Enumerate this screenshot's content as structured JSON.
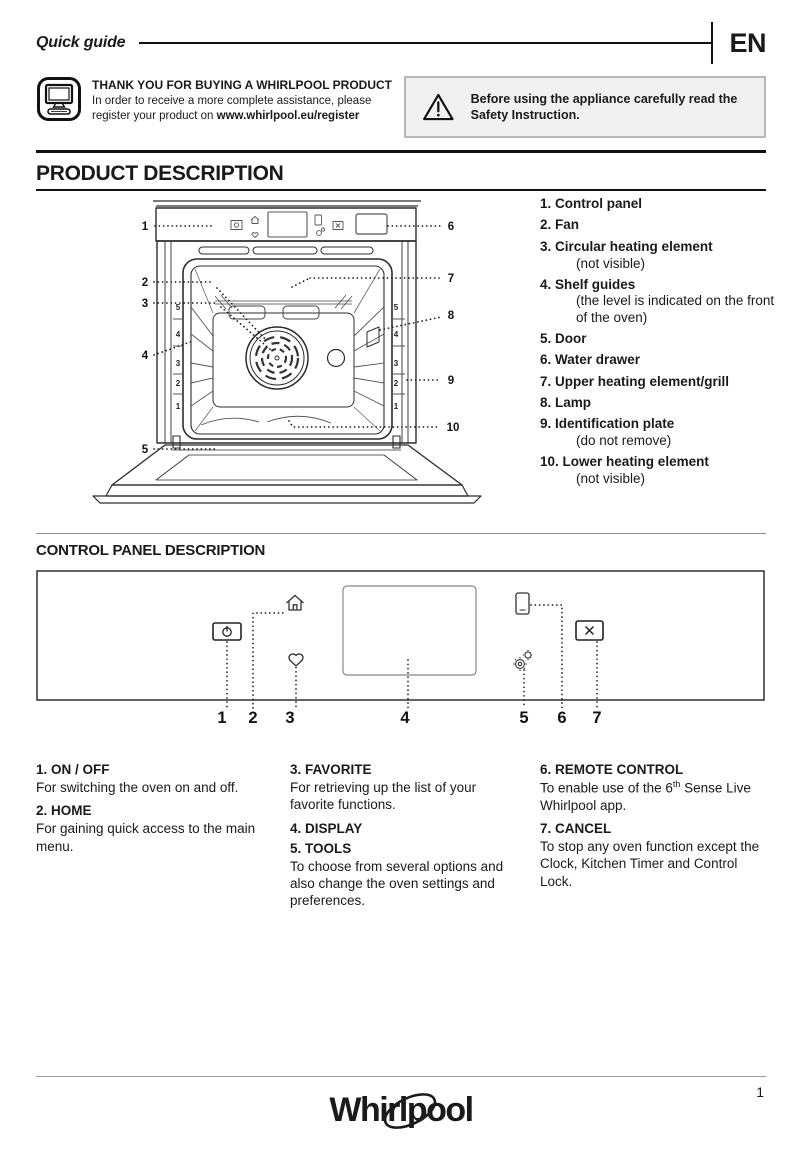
{
  "header": {
    "title": "Quick guide",
    "lang": "EN"
  },
  "register": {
    "title": "THANK YOU FOR BUYING A WHIRLPOOL PRODUCT",
    "line1": "In order to receive a more complete assistance, please",
    "line2": "register your product on ",
    "url": "www.whirlpool.eu/register"
  },
  "warning": {
    "text": "Before using the appliance carefully read the Safety Instruction."
  },
  "product": {
    "heading": "PRODUCT DESCRIPTION",
    "parts": [
      {
        "num": "1.",
        "name": "Control panel"
      },
      {
        "num": "2.",
        "name": "Fan"
      },
      {
        "num": "3.",
        "name": "Circular heating element",
        "note": "(not visible)"
      },
      {
        "num": "4.",
        "name": "Shelf guides",
        "note": "(the level is indicated on the front of the oven)"
      },
      {
        "num": "5.",
        "name": "Door"
      },
      {
        "num": "6.",
        "name": "Water drawer"
      },
      {
        "num": "7.",
        "name": "Upper heating element/grill"
      },
      {
        "num": "8.",
        "name": "Lamp"
      },
      {
        "num": "9.",
        "name": "Identification plate",
        "note": "(do not remove)"
      },
      {
        "num": "10.",
        "name": "Lower heating element",
        "note": "(not visible)"
      }
    ],
    "callouts": [
      "1",
      "2",
      "3",
      "4",
      "5",
      "6",
      "7",
      "8",
      "9",
      "10"
    ],
    "shelf_levels": [
      "5",
      "4",
      "3",
      "2",
      "1"
    ]
  },
  "control_panel": {
    "heading": "CONTROL PANEL DESCRIPTION",
    "callouts": [
      "1",
      "2",
      "3",
      "4",
      "5",
      "6",
      "7"
    ],
    "icons": [
      "power-icon",
      "home-icon",
      "favorite-heart-icon",
      "display-screen",
      "tools-gear-icon",
      "remote-phone-icon",
      "cancel-x-icon"
    ]
  },
  "descriptions": {
    "col1": [
      {
        "title": "1. ON / OFF",
        "text": "For switching the oven on and off."
      },
      {
        "title": "2. HOME",
        "text": "For gaining quick access to the main menu."
      }
    ],
    "col2": [
      {
        "title": "3. FAVORITE",
        "text": "For retrieving up the list of your favorite functions."
      },
      {
        "title": "4. DISPLAY",
        "text": ""
      },
      {
        "title": "5. TOOLS",
        "text": "To choose from several options and also change the oven settings and preferences."
      }
    ],
    "col3": [
      {
        "title": "6. REMOTE CONTROL",
        "pre": "To enable use of the 6",
        "sup": "th",
        "post": " Sense Live Whirlpool app."
      },
      {
        "title": "7. CANCEL",
        "text": "To stop any oven function except the Clock, Kitchen Timer and Control Lock."
      }
    ]
  },
  "footer": {
    "brand": "Whirlpool",
    "page": "1"
  },
  "colors": {
    "warning_bg": "#f1f1f1",
    "warning_border": "#b7b7b7",
    "ink": "#1a1a1a"
  }
}
